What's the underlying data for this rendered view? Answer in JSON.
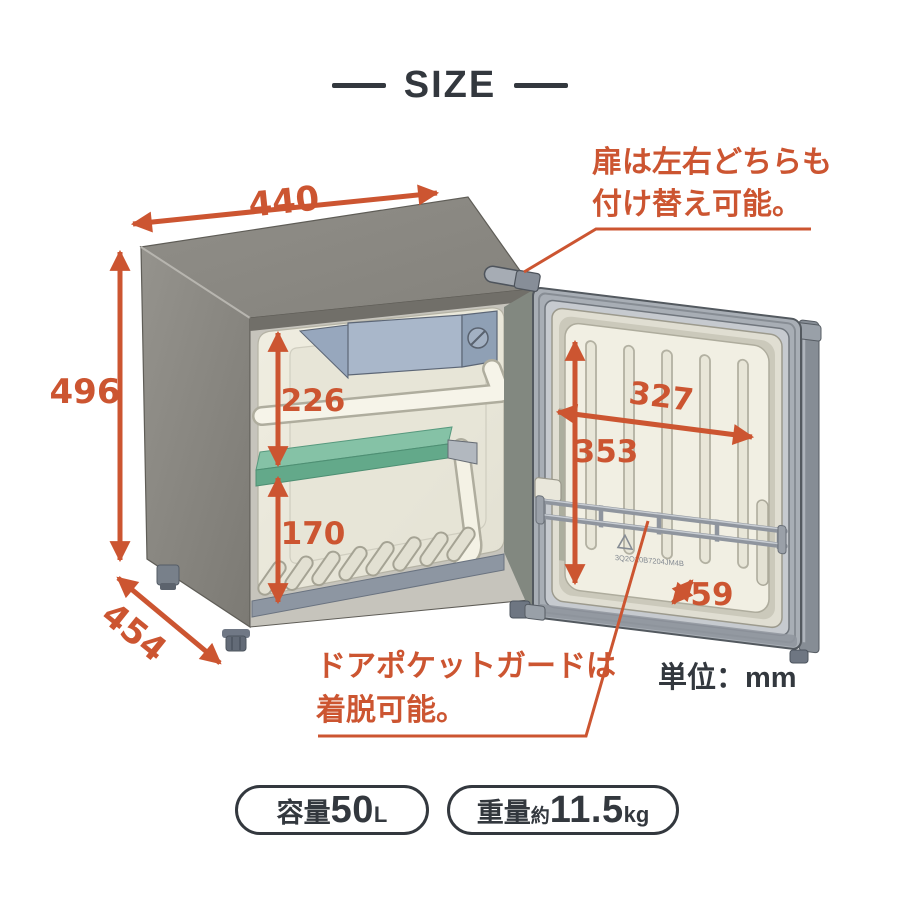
{
  "colors": {
    "accent": "#CC5531",
    "dark": "#33383E",
    "shelf_green": "#6FB394",
    "cabinet_gray": "#8B8981"
  },
  "header": {
    "title": "SIZE"
  },
  "dimensions": {
    "top_width": "440",
    "left_height": "496",
    "bottom_depth": "454",
    "upper_interior_height": "226",
    "lower_interior_height": "170",
    "door_inner_width": "327",
    "door_inner_height": "353",
    "door_pocket_depth": "59"
  },
  "annotations": {
    "door_reversible_line1": "扉は左右どちらも",
    "door_reversible_line2": "付け替え可能。",
    "pocket_guard_line1": "ドアポケットガードは",
    "pocket_guard_line2": "着脱可能。",
    "unit_label": "単位：mm"
  },
  "badges": {
    "capacity_prefix": "容量",
    "capacity_value": "50",
    "capacity_unit": "L",
    "weight_prefix": "重量",
    "weight_approx": "約",
    "weight_value": "11.5",
    "weight_unit": "kg"
  },
  "illustration": {
    "serial_text": "3Q2O20B7204JM4B"
  }
}
